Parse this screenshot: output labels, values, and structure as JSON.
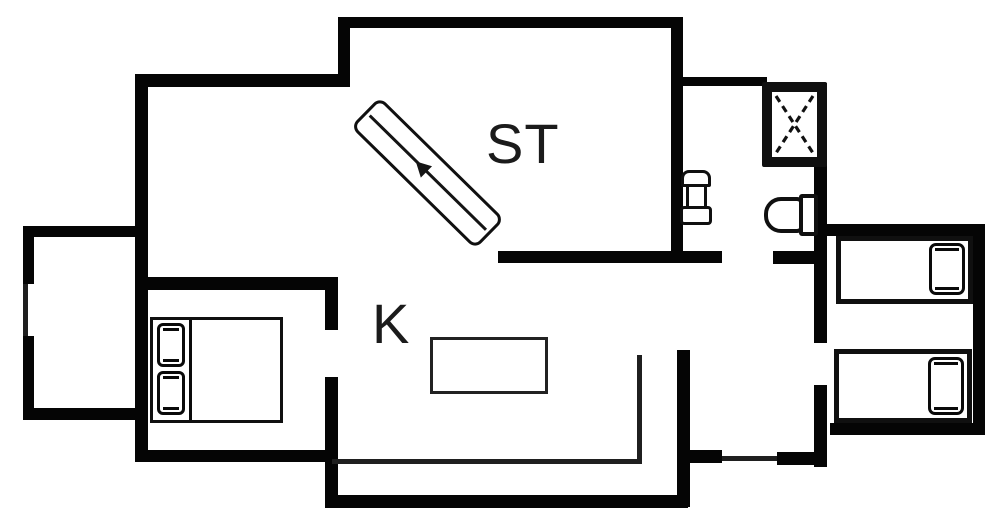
{
  "meta": {
    "background_color": "#ffffff",
    "wall_color": "#050505",
    "thin_line_color": "#1f1f1f",
    "text_color": "#1b1b1b"
  },
  "labels": {
    "living_room": "ST",
    "kitchen": "K"
  },
  "fixtures": [
    {
      "name": "loft-stair",
      "room": "living-room"
    },
    {
      "name": "shower-stall",
      "room": "bathroom"
    },
    {
      "name": "washbasin",
      "room": "bathroom"
    },
    {
      "name": "toilet",
      "room": "bathroom"
    },
    {
      "name": "double-bed",
      "room": "bedroom-left"
    },
    {
      "name": "kitchen-table",
      "room": "kitchen"
    },
    {
      "name": "kitchen-counter",
      "room": "kitchen"
    },
    {
      "name": "single-bed",
      "room": "bedroom-right"
    },
    {
      "name": "single-bed",
      "room": "bedroom-right"
    },
    {
      "name": "window",
      "room": "annex"
    }
  ],
  "floorplan": {
    "canvas": {
      "width": 1000,
      "height": 517
    },
    "walls": [
      {
        "name": "outer-wall-left",
        "x": 135,
        "y": 74,
        "w": 13,
        "h": 388
      },
      {
        "name": "wall-upper-left-top",
        "x": 135,
        "y": 74,
        "w": 215,
        "h": 13
      },
      {
        "name": "wall-st-step",
        "x": 338,
        "y": 17,
        "w": 12,
        "h": 70
      },
      {
        "name": "wall-st-top",
        "x": 338,
        "y": 17,
        "w": 345,
        "h": 11
      },
      {
        "name": "wall-st-right",
        "x": 671,
        "y": 17,
        "w": 12,
        "h": 246
      },
      {
        "name": "wall-st-bottom",
        "x": 498,
        "y": 251,
        "w": 224,
        "h": 12
      },
      {
        "name": "wall-bath-top",
        "x": 683,
        "y": 77,
        "w": 84,
        "h": 9
      },
      {
        "name": "wall-bath-right",
        "x": 814,
        "y": 83,
        "w": 13,
        "h": 154
      },
      {
        "name": "wall-bath-door-stub",
        "x": 773,
        "y": 251,
        "w": 44,
        "h": 13
      },
      {
        "name": "wall-bedroom2-north",
        "x": 822,
        "y": 224,
        "w": 163,
        "h": 12
      },
      {
        "name": "wall-bedroom2-east",
        "x": 973,
        "y": 224,
        "w": 12,
        "h": 211
      },
      {
        "name": "wall-bedroom2-south",
        "x": 830,
        "y": 423,
        "w": 145,
        "h": 12
      },
      {
        "name": "wall-bedroom2-west-upper",
        "x": 814,
        "y": 228,
        "w": 13,
        "h": 115
      },
      {
        "name": "wall-bedroom2-west-lower",
        "x": 814,
        "y": 385,
        "w": 13,
        "h": 82
      },
      {
        "name": "wall-hall-south-left",
        "x": 690,
        "y": 450,
        "w": 32,
        "h": 13
      },
      {
        "name": "wall-hall-south-right",
        "x": 777,
        "y": 452,
        "w": 50,
        "h": 13
      },
      {
        "name": "wall-kitchen-east",
        "x": 677,
        "y": 350,
        "w": 13,
        "h": 157
      },
      {
        "name": "wall-kitchen-south",
        "x": 330,
        "y": 495,
        "w": 358,
        "h": 13
      },
      {
        "name": "wall-kitchen-west",
        "x": 325,
        "y": 377,
        "w": 13,
        "h": 131
      },
      {
        "name": "wall-bedroom1-doorpost",
        "x": 325,
        "y": 277,
        "w": 13,
        "h": 53
      },
      {
        "name": "wall-bedroom1-north",
        "x": 135,
        "y": 277,
        "w": 203,
        "h": 13
      },
      {
        "name": "wall-bedroom1-south",
        "x": 135,
        "y": 450,
        "w": 200,
        "h": 12
      },
      {
        "name": "wall-annex-north",
        "x": 25,
        "y": 226,
        "w": 112,
        "h": 11
      },
      {
        "name": "wall-annex-west-upper",
        "x": 23,
        "y": 226,
        "w": 11,
        "h": 58
      },
      {
        "name": "wall-annex-west-lower",
        "x": 23,
        "y": 336,
        "w": 11,
        "h": 84
      },
      {
        "name": "wall-annex-south",
        "x": 23,
        "y": 408,
        "w": 114,
        "h": 12
      }
    ],
    "thin_lines": [
      {
        "name": "window-annex-west",
        "x": 23,
        "y": 284,
        "w": 5,
        "h": 52
      },
      {
        "name": "kitchen-counter-front",
        "x": 332,
        "y": 459,
        "w": 308,
        "h": 5
      },
      {
        "name": "kitchen-counter-side",
        "x": 637,
        "y": 355,
        "w": 5,
        "h": 109
      },
      {
        "name": "door-threshold-south",
        "x": 722,
        "y": 456,
        "w": 55,
        "h": 5
      }
    ]
  }
}
